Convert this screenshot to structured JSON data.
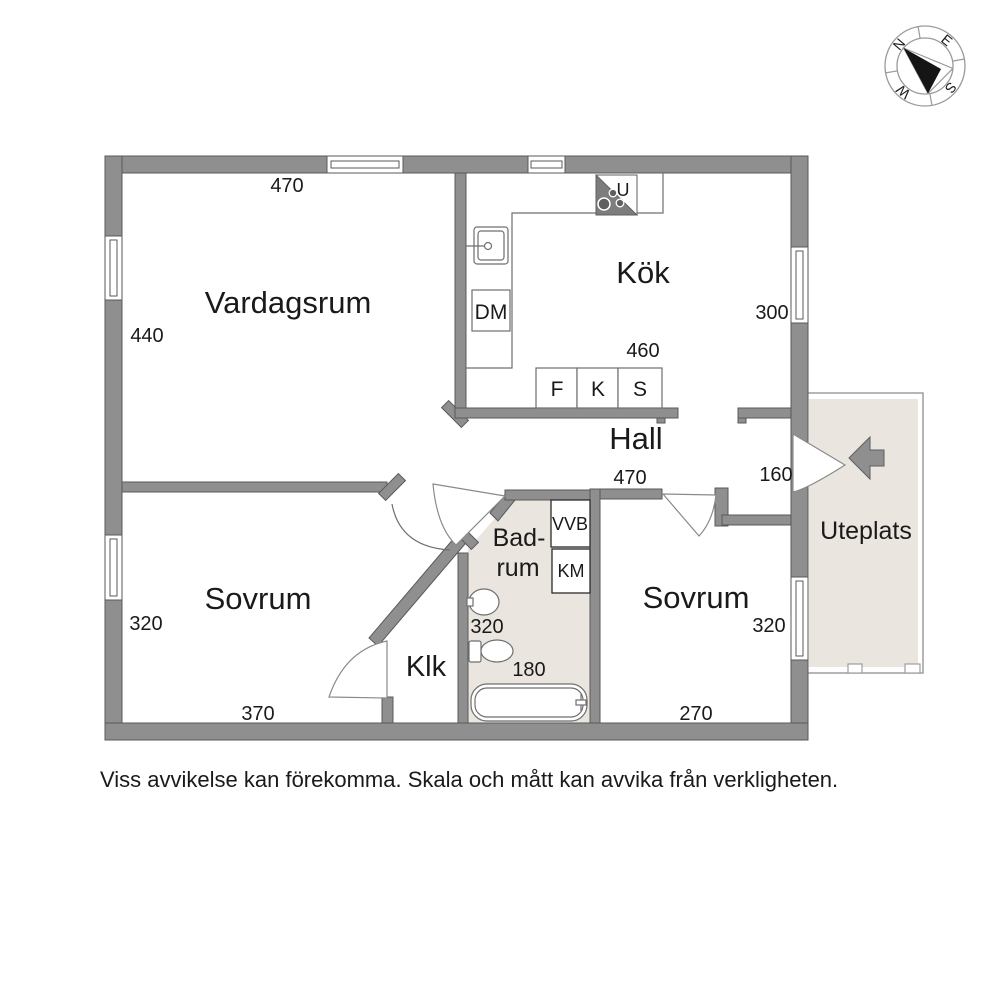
{
  "rooms": {
    "vardagsrum": "Vardagsrum",
    "kok": "Kök",
    "hall": "Hall",
    "sovrum1": "Sovrum",
    "sovrum2": "Sovrum",
    "klk": "Klk",
    "badrum_line1": "Bad-",
    "badrum_line2": "rum",
    "uteplats": "Uteplats"
  },
  "dims": {
    "vardagsrum_w": "470",
    "vardagsrum_h": "440",
    "kok_h": "300",
    "kok_w": "460",
    "hall_w": "470",
    "entry_w": "160",
    "sovrum1_h": "320",
    "sovrum1_w": "370",
    "badrum_h": "320",
    "badrum_w": "180",
    "sovrum2_h": "320",
    "sovrum2_w": "270"
  },
  "appliances": {
    "stove": "U",
    "dishwasher": "DM",
    "fridge": "F",
    "freezer": "K",
    "pantry": "S",
    "water_heater": "VVB",
    "washing_machine": "KM"
  },
  "compass": {
    "north": "N",
    "east": "E",
    "south": "S",
    "west": "W"
  },
  "footer": {
    "disclaimer": "Viss avvikelse kan förekomma. Skala och mått kan avvika från verkligheten."
  },
  "colors": {
    "wall": "#8F8F8F",
    "patio_fill": "#EAE5DF",
    "text": "#1A1A1A"
  }
}
